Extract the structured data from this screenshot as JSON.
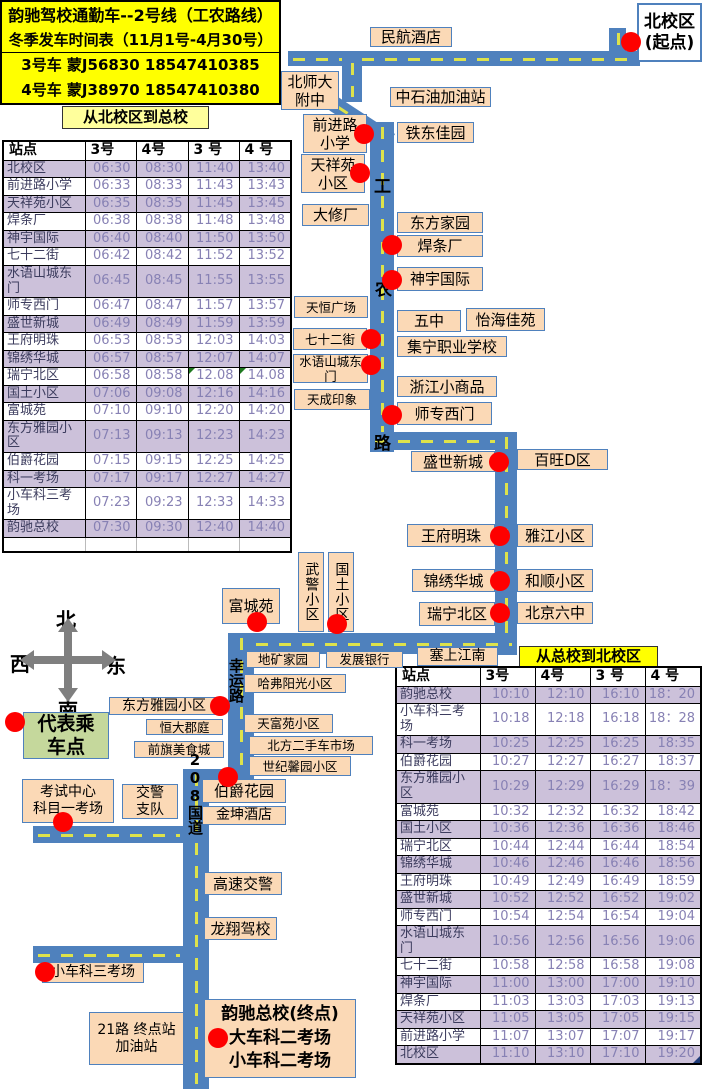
{
  "header": {
    "title_line1": "韵驰驾校通勤车--2号线（工农路线）",
    "title_line2": "冬季发车时间表（11月1号-4月30号）",
    "bus3": "3号车 蒙J56830 18547410385",
    "bus4": "4号车 蒙J38970 18547410380"
  },
  "section_titles": {
    "to_main": "从北校区到总校",
    "to_north": "从总校到北校区"
  },
  "legend": {
    "text": "代表乘\n车点"
  },
  "compass": {
    "north": "北",
    "south": "南",
    "west": "西",
    "east": "东"
  },
  "tables": {
    "to_main": {
      "columns": [
        "站点",
        "3号",
        "4号",
        "3 号",
        "4 号"
      ],
      "rows": [
        [
          "北校区",
          "06:30",
          "08:30",
          "11:40",
          "13:40"
        ],
        [
          "前进路小学",
          "06:33",
          "08:33",
          "11:43",
          "13:43"
        ],
        [
          "天祥苑小区",
          "06:35",
          "08:35",
          "11:45",
          "13:45"
        ],
        [
          "焊条厂",
          "06:38",
          "08:38",
          "11:48",
          "13:48"
        ],
        [
          "神宇国际",
          "06:40",
          "08:40",
          "11:50",
          "13:50"
        ],
        [
          "七十二街",
          "06:42",
          "08:42",
          "11:52",
          "13:52"
        ],
        [
          "水语山城东门",
          "06:45",
          "08:45",
          "11:55",
          "13:55"
        ],
        [
          "师专西门",
          "06:47",
          "08:47",
          "11:57",
          "13:57"
        ],
        [
          "盛世新城",
          "06:49",
          "08:49",
          "11:59",
          "13:59"
        ],
        [
          "王府明珠",
          "06:53",
          "08:53",
          "12:03",
          "14:03"
        ],
        [
          "锦绣华城",
          "06:57",
          "08:57",
          "12:07",
          "14:07"
        ],
        [
          "瑞宁北区",
          "06:58",
          "08:58",
          "12.08",
          "14.08"
        ],
        [
          "国土小区",
          "07:06",
          "09:08",
          "12:16",
          "14:16"
        ],
        [
          "富城苑",
          "07:10",
          "09:10",
          "12:20",
          "14:20"
        ],
        [
          "东方雅园小区",
          "07:13",
          "09:13",
          "12:23",
          "14:23"
        ],
        [
          "伯爵花园",
          "07:15",
          "09:15",
          "12:25",
          "14:25"
        ],
        [
          "科一考场",
          "07:17",
          "09:17",
          "12:27",
          "14:27"
        ],
        [
          "小车科三考场",
          "07:23",
          "09:23",
          "12:33",
          "14:33"
        ],
        [
          "韵驰总校",
          "07:30",
          "09:30",
          "12:40",
          "14:40"
        ]
      ],
      "flag_cells": [
        [
          11,
          3
        ],
        [
          11,
          4
        ]
      ],
      "trailing_empty_rows": 1
    },
    "to_north": {
      "columns": [
        "站点",
        "3号",
        "4号",
        "3 号",
        "4 号"
      ],
      "rows": [
        [
          "韵驰总校",
          "10:10",
          "12:10",
          "16:10",
          "18：20"
        ],
        [
          "小车科三考场",
          "10:18",
          "12:18",
          "16:18",
          "18：28"
        ],
        [
          "科一考场",
          "10:25",
          "12:25",
          "16:25",
          "18:35"
        ],
        [
          "伯爵花园",
          "10:27",
          "12:27",
          "16:27",
          "18:37"
        ],
        [
          "东方雅园小区",
          "10:29",
          "12:29",
          "16:29",
          "18：39"
        ],
        [
          "富城苑",
          "10:32",
          "12:32",
          "16:32",
          "18:42"
        ],
        [
          "国土小区",
          "10:36",
          "12:36",
          "16:36",
          "18:46"
        ],
        [
          "瑞宁北区",
          "10:44",
          "12:44",
          "16:44",
          "18:54"
        ],
        [
          "锦绣华城",
          "10:46",
          "12:46",
          "16:46",
          "18:56"
        ],
        [
          "王府明珠",
          "10:49",
          "12:49",
          "16:49",
          "18:59"
        ],
        [
          "盛世新城",
          "10:52",
          "12:52",
          "16:52",
          "19:02"
        ],
        [
          "师专西门",
          "10:54",
          "12:54",
          "16:54",
          "19:04"
        ],
        [
          "水语山城东门",
          "10:56",
          "12:56",
          "16:56",
          "19:06"
        ],
        [
          "七十二街",
          "10:58",
          "12:58",
          "16:58",
          "19:08"
        ],
        [
          "神宇国际",
          "11:00",
          "13:00",
          "17:00",
          "19:10"
        ],
        [
          "焊条厂",
          "11:03",
          "13:03",
          "17:03",
          "19:13"
        ],
        [
          "天祥苑小区",
          "11:05",
          "13:05",
          "17:05",
          "19:15"
        ],
        [
          "前进路小学",
          "11:07",
          "13:07",
          "17:07",
          "19:17"
        ],
        [
          "北校区",
          "11:10",
          "13:10",
          "17:10",
          "19:20"
        ]
      ],
      "flag_cells": [],
      "corner_last_cell": true,
      "trailing_empty_rows": 0
    }
  },
  "map": {
    "origin": "北校区\n(起点)",
    "terminus": "韵驰总校(终点)\n大车科二考场\n小车科二考场",
    "road_names": {
      "gongnong_chars": [
        "工",
        "农",
        "路"
      ],
      "xingyun": "幸运路",
      "guodao": "208国道"
    },
    "labels": {
      "minhang": "民航酒店",
      "beishida": "北师大\n附中",
      "zhongshiyou": "中石油加油站",
      "qianjinlu": "前进路\n小学",
      "tiedong": "铁东佳园",
      "tianxiangyuan": "天祥苑\n小区",
      "daxiuchang": "大修厂",
      "dongfangjiayuan": "东方家园",
      "hantiaochang": "焊条厂",
      "shenyu": "神宇国际",
      "tianheng": "天恒广场",
      "wuzhong": "五中",
      "yihai": "怡海佳苑",
      "qishier": "七十二街",
      "jiningzhiye": "集宁职业学校",
      "shuiyu": "水语山城东\n门",
      "zhejiang": "浙江小商品",
      "tiancheng": "天成印象",
      "shizhuan": "师专西门",
      "shengshi": "盛世新城",
      "baiwang": "百旺D区",
      "wangfu": "王府明珠",
      "yajiang": "雅江小区",
      "jinxiu": "锦绣华城",
      "heshun": "和顺小区",
      "ruining": "瑞宁北区",
      "beijingliuzhong": "北京六中",
      "wujing": "武警小区",
      "guotu": "国土小区",
      "dikuang": "地矿家园",
      "fazhan": "发展银行",
      "saishang": "塞上江南",
      "fuchengyuan": "富城苑",
      "dongfangyayuan": "东方雅园小区",
      "hengda": "恒大郡庭",
      "qianqi": "前旗美食城",
      "hafu": "哈弗阳光小区",
      "tianfu": "天富苑小区",
      "beifang": "北方二手车市场",
      "shiji": "世纪馨园小区",
      "bojue": "伯爵花园",
      "jinkun": "金坤酒店",
      "kaoshi": "考试中心\n科目一考场",
      "jiaojing": "交警\n支队",
      "gaosu": "高速交警",
      "longxiang": "龙翔驾校",
      "xiaochekesan": "小车科三考场",
      "ershiyilu": "21路 终点站\n加油站"
    },
    "stops_with_dots": [
      "北校区(起点)",
      "前进路小学",
      "天祥苑小区",
      "焊条厂",
      "神宇国际",
      "七十二街",
      "水语山城东门",
      "师专西门",
      "盛世新城",
      "王府明珠",
      "锦绣华城",
      "瑞宁北区",
      "国土小区",
      "富城苑",
      "东方雅园小区",
      "伯爵花园",
      "考试中心科目一考场",
      "小车科三考场",
      "韵驰总校(终点)"
    ]
  },
  "colors": {
    "road_blue": "#4F81BD",
    "dash_yellow_green": "#DDE24B",
    "label_peach": "#FBD9B6",
    "highlight_yellow": "#FFFF00",
    "pale_yellow": "#FFFF9C",
    "row_lavender": "#CCC1DA",
    "stop_red": "#FE0000",
    "legend_green": "#C5D89C"
  }
}
